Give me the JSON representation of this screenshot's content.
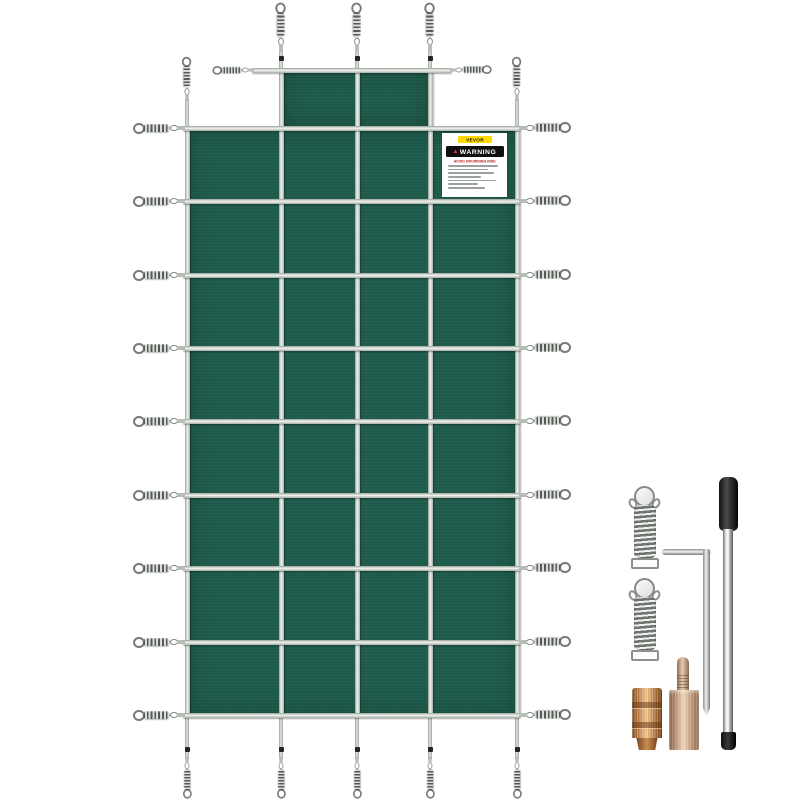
{
  "image": {
    "width": 800,
    "height": 800,
    "background": "#ffffff",
    "description": "Product photo of a green rectangular in-ground pool safety cover with a center step extension, perimeter tension springs, and an installation hardware kit"
  },
  "cover": {
    "fabric_color": "#1e5c4c",
    "strap_color": "#c6ccc6",
    "grid": {
      "columns": 4,
      "rows": 8,
      "step_columns": 2
    },
    "hardware_counts": {
      "left_springs": 9,
      "right_springs": 9,
      "top_springs": 5,
      "bottom_springs": 5,
      "step_side_springs": 2
    },
    "label": {
      "brand": "VEVOR",
      "brand_bg": "#ffd900",
      "warning_title": "WARNING",
      "warning_subtitle": "AVOID DROWNING RISK",
      "fine_print_line_widths_pct": [
        94,
        76,
        86,
        62,
        90,
        56,
        70
      ]
    }
  },
  "accessories": {
    "items": [
      {
        "id": "cover-spring-1",
        "label": "stainless steel tension spring"
      },
      {
        "id": "cover-spring-2",
        "label": "stainless steel tension spring"
      },
      {
        "id": "hex-key",
        "label": "L-shaped installation hex key"
      },
      {
        "id": "installation-rod",
        "label": "anchor installation rod",
        "handle_color": "#1a1a1a"
      },
      {
        "id": "brass-anchor",
        "label": "brass deck anchor",
        "color": "#c98840"
      },
      {
        "id": "pin-anchor",
        "label": "deck anchor with tamping pin",
        "color": "#cfa584"
      }
    ]
  },
  "colors": {
    "fabric": "#1e5c4c",
    "strap": "#c6ccc6",
    "spring_metal": "#8d918e",
    "brand_yellow": "#ffd900",
    "warning_black": "#0f0f0f",
    "warning_red": "#b31c1c",
    "brass": "#c98840",
    "copper_rose": "#cfa584",
    "rod_handle": "#1a1a1a"
  }
}
